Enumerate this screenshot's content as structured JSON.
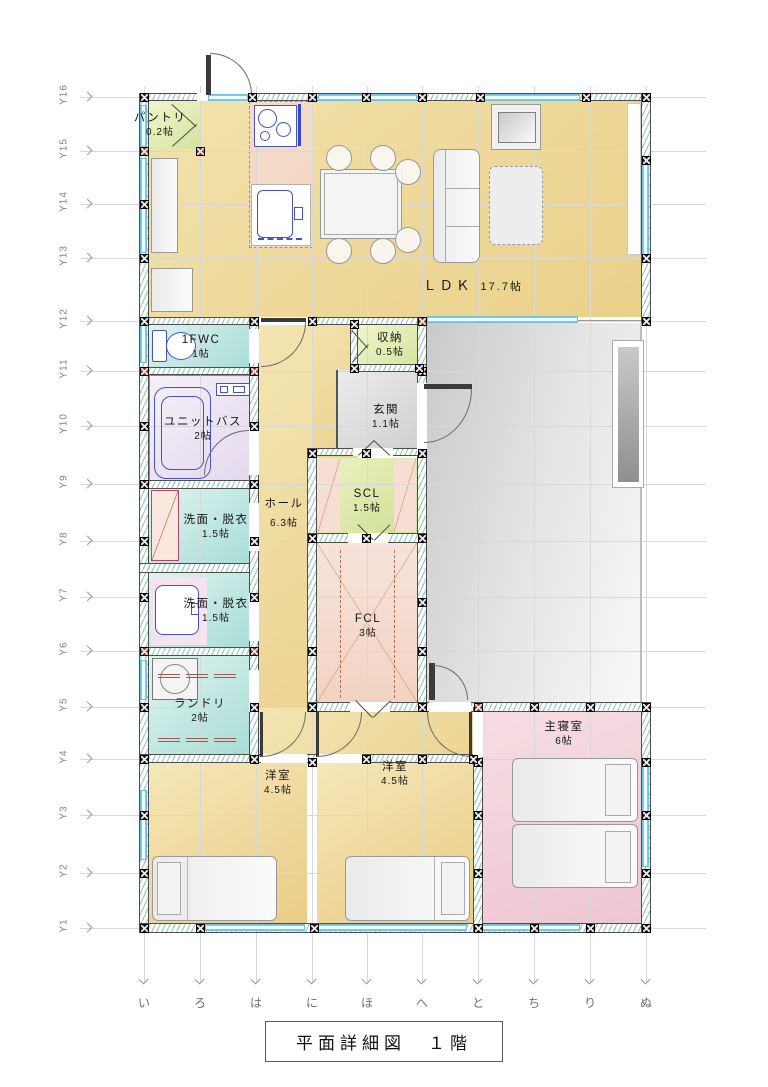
{
  "title": "平面詳細図　１階",
  "grid": {
    "y_labels": [
      "Y16",
      "Y15",
      "Y14",
      "Y13",
      "Y12",
      "Y11",
      "Y10",
      "Y9",
      "Y8",
      "Y7",
      "Y6",
      "Y5",
      "Y4",
      "Y3",
      "Y2",
      "Y1"
    ],
    "x_labels": [
      "い",
      "ろ",
      "は",
      "に",
      "ほ",
      "へ",
      "と",
      "ち",
      "り",
      "ぬ"
    ]
  },
  "rooms": {
    "pantry": {
      "name": "パントリ",
      "size": "0.2帖"
    },
    "ldk": {
      "name": "ＬＤＫ",
      "size": "17.7帖"
    },
    "wc": {
      "name": "1FWC",
      "size": "1帖"
    },
    "unit_bath": {
      "name": "ユニットバス",
      "size": "2帖"
    },
    "storage": {
      "name": "収納",
      "size": "0.5帖"
    },
    "entrance": {
      "name": "玄関",
      "size": "1.1帖"
    },
    "scl": {
      "name": "SCL",
      "size": "1.5帖"
    },
    "hall": {
      "name": "ホール",
      "size": "6.3帖"
    },
    "washroom1": {
      "name": "洗面・脱衣",
      "size": "1.5帖"
    },
    "washroom2": {
      "name": "洗面・脱衣",
      "size": "1.5帖"
    },
    "fcl": {
      "name": "FCL",
      "size": "3帖"
    },
    "laundry": {
      "name": "ランドリ",
      "size": "2帖"
    },
    "bedroom1": {
      "name": "洋室",
      "size": "4.5帖"
    },
    "bedroom2": {
      "name": "洋室",
      "size": "4.5帖"
    },
    "master_bedroom": {
      "name": "主寝室",
      "size": "6帖"
    }
  },
  "colors": {
    "wall_hatch": "#2e8b74",
    "window": "#6cc3e0",
    "fixture_line": "#4653c8",
    "floor_wood": "#ead089",
    "floor_pink": "#eec6d1",
    "floor_green": "#d4e49c",
    "floor_cyan": "#a8dcd6",
    "porch_gray": "#d9d9d9"
  }
}
